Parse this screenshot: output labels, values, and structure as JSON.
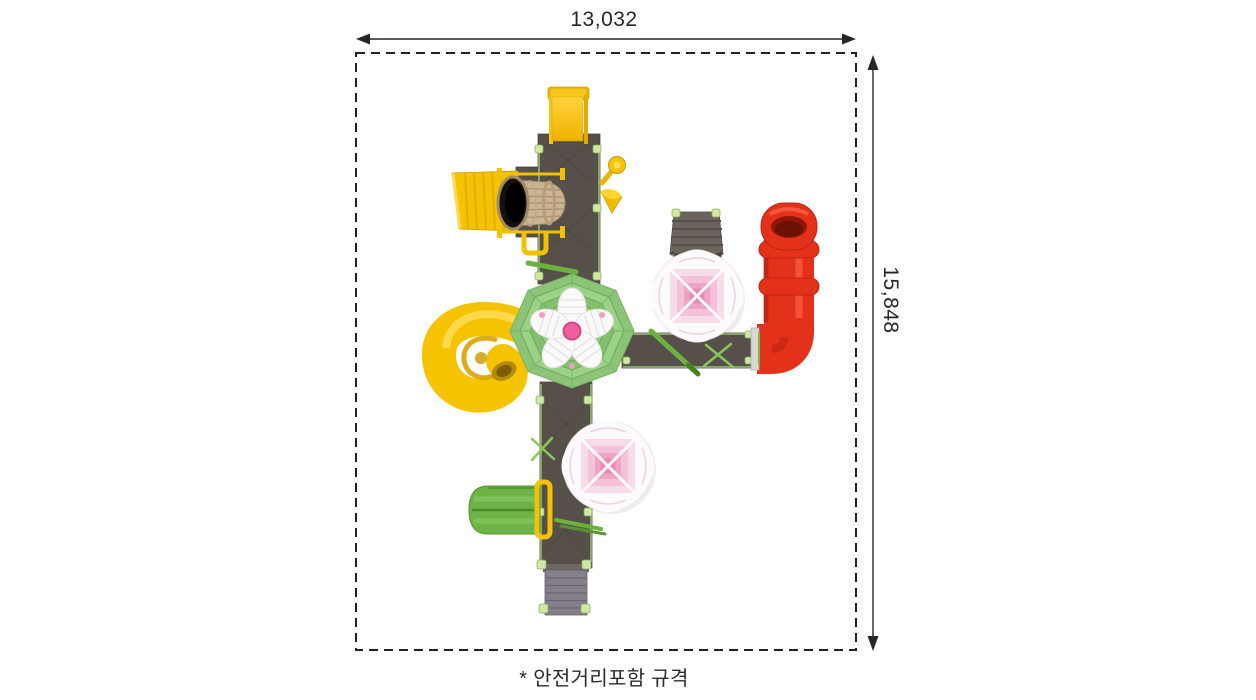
{
  "dimensions": {
    "width_label": "13,032",
    "height_label": "15,848"
  },
  "caption": "* 안전거리포함 규격",
  "colors": {
    "ink": "#2b2522",
    "platform": "#57504a",
    "stair_gray": "#847f88",
    "pad_green": "#cfe8a4",
    "rail_green": "#6cb23e",
    "roof_green": "#8cc577",
    "flower_pink": "#ee5f9e",
    "canopy_pink": "#f3c1d8",
    "yellow": "#f5c300",
    "yellow_dark": "#d9a400",
    "red": "#e43119",
    "red_dark": "#b32112",
    "slide_green": "#6db347",
    "wood": "#cbb493"
  },
  "equipment_parts": [
    "top-straight-slide",
    "barrel-crawl-tunnel",
    "yellow-climb-ramp",
    "periscope",
    "octagon-flower-roof",
    "yellow-spiral-tube-slide",
    "east-bridge-walkway",
    "north-access-ramp",
    "upper-shade-canopy",
    "red-curved-tube-slide",
    "lower-shade-canopy",
    "green-double-slide",
    "entry-stairs",
    "deck-platforms"
  ]
}
